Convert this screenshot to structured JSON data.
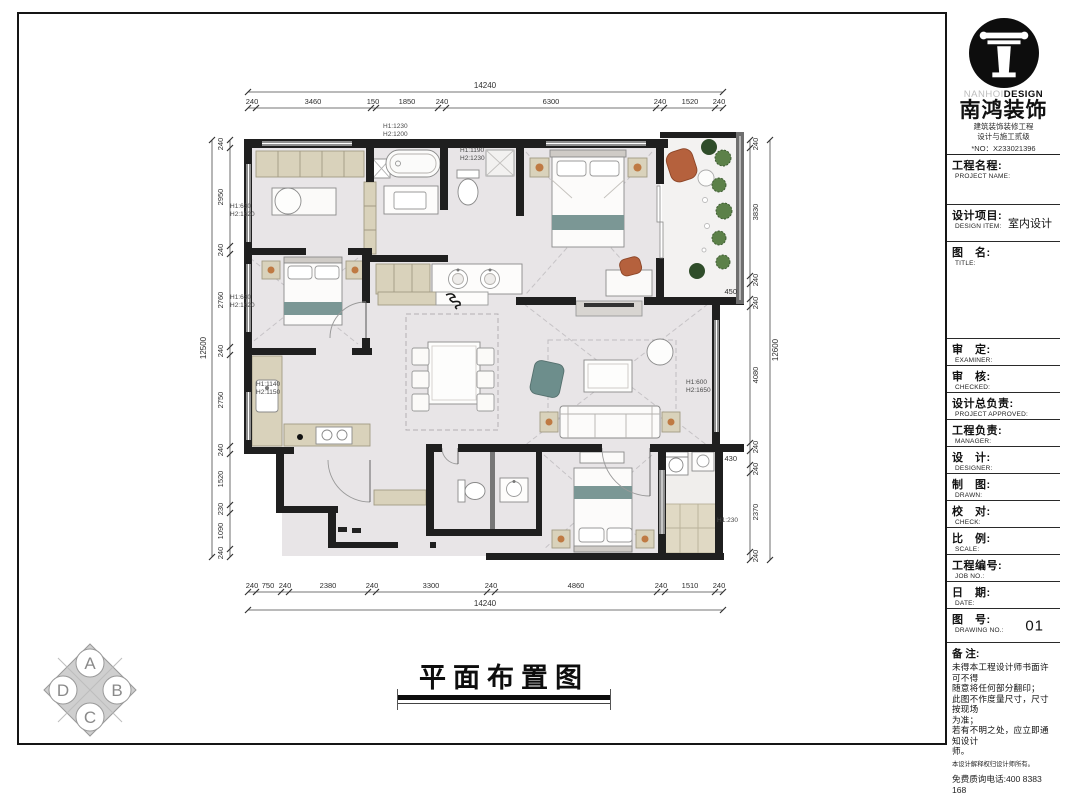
{
  "sheet": {
    "title": "平面布置图"
  },
  "brand": {
    "logo_en_light": "NANHOI",
    "logo_en_bold": "DESIGN",
    "name_cn": "南鸿装饰",
    "cert_line1": "建筑装饰装修工程",
    "cert_line2": "设计与施工贰级",
    "cert_no": "*NO：X233021396"
  },
  "title_block": {
    "rows": [
      {
        "cn": "工程名程:",
        "en": "PROJECT NAME:",
        "value": ""
      },
      {
        "cn": "设计项目:",
        "en": "DESIGN ITEM:",
        "value": "室内设计"
      },
      {
        "cn": "图　名:",
        "en": "TITLE:",
        "value": ""
      },
      {
        "cn": "审　定:",
        "en": "EXAMINER:",
        "value": ""
      },
      {
        "cn": "审　核:",
        "en": "CHECKED:",
        "value": ""
      },
      {
        "cn": "设计总负责:",
        "en": "PROJECT APPROVED:",
        "value": ""
      },
      {
        "cn": "工程负责:",
        "en": "MANAGER:",
        "value": ""
      },
      {
        "cn": "设　计:",
        "en": "DESIGNER:",
        "value": ""
      },
      {
        "cn": "制　图:",
        "en": "DRAWN:",
        "value": ""
      },
      {
        "cn": "校　对:",
        "en": "CHECK:",
        "value": ""
      },
      {
        "cn": "比　例:",
        "en": "SCALE:",
        "value": ""
      },
      {
        "cn": "工程编号:",
        "en": "JOB NO.:",
        "value": ""
      },
      {
        "cn": "日　期:",
        "en": "DATE:",
        "value": ""
      },
      {
        "cn": "图　号:",
        "en": "DRAWING NO.:",
        "value": "01"
      }
    ],
    "notes": {
      "label": "备 注:",
      "lines": [
        "未得本工程设计师书面许可不得",
        "随意将任何部分翻印；",
        "此图不作度量尺寸，尺寸按现场",
        "为准；",
        "若有不明之处，应立即通知设计",
        "师。"
      ],
      "small": "本设计解释权归设计师所有。",
      "phone": "免费质询电话:400 8383 168"
    }
  },
  "plan": {
    "dims_top": {
      "total": "14240",
      "segs": [
        "240",
        "3460",
        "150",
        "1850",
        "240",
        "6300",
        "240",
        "1520",
        "240"
      ]
    },
    "dims_bottom": {
      "total": "14240",
      "segs": [
        "240",
        "750",
        "240",
        "2380",
        "240",
        "3300",
        "240",
        "4860",
        "240",
        "1510",
        "240"
      ]
    },
    "dims_left": {
      "total": "12500",
      "segs": [
        "240",
        "2950",
        "240",
        "2760",
        "240",
        "2750",
        "240",
        "1520",
        "230",
        "1090",
        "240"
      ]
    },
    "dims_right": {
      "total": "12600",
      "segs": [
        "240",
        "3830",
        "240",
        "450",
        "240",
        "4080",
        "240",
        "430",
        "240",
        "2370",
        "240"
      ]
    },
    "annotations": [
      {
        "l1": "H1:1230",
        "l2": "H2:1200"
      },
      {
        "l1": "H1:1190",
        "l2": "H2:1230"
      },
      {
        "l1": "H1:630",
        "l2": "H2:1620"
      },
      {
        "l1": "H1:630",
        "l2": "H2:1620"
      },
      {
        "l1": "H1:1140",
        "l2": "H2:1150"
      },
      {
        "l1": "H1:600",
        "l2": "H2:1650"
      },
      {
        "l1": "H1:230",
        "l2": ""
      }
    ]
  },
  "corner_mark": {
    "top": "A",
    "right": "B",
    "bottom": "C",
    "left": "D"
  },
  "colors": {
    "wall": "#1f1f1f",
    "window": "#8e8e8e",
    "floor": "#e8e5e7",
    "wood": "#d9d2bb",
    "teal": "#7b9795",
    "terracotta": "#b5613d",
    "plant": "#5c8149",
    "accent_black": "#0d0d0d"
  }
}
